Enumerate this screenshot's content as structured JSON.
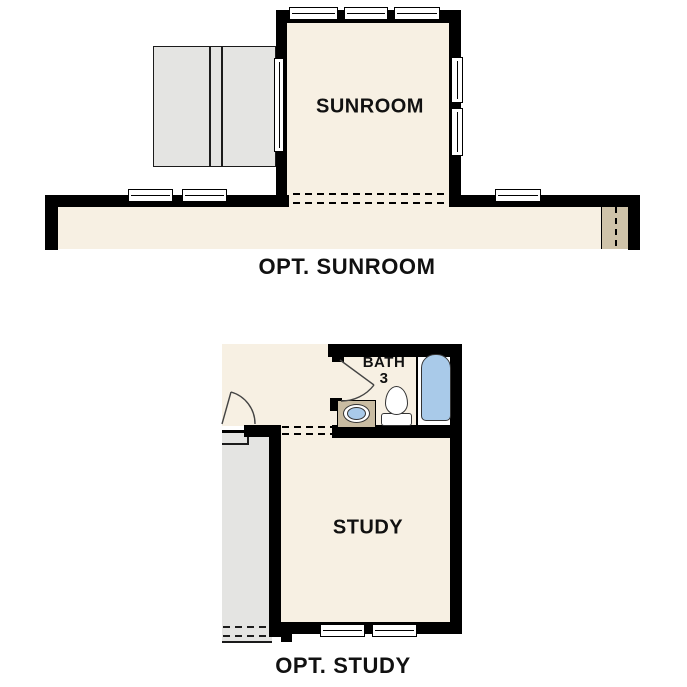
{
  "plans": {
    "sunroom": {
      "caption": "OPT. SUNROOM",
      "room_label": "SUNROOM"
    },
    "study": {
      "caption": "OPT. STUDY",
      "room_label": "STUDY",
      "bath": {
        "label": "BATH",
        "number": "3"
      }
    }
  },
  "colors": {
    "bg": "#ffffff",
    "wall": "#000000",
    "floor": "#f7f0e3",
    "deck": "#e4e4e2",
    "deck_outline": "#1b1b1b",
    "tan_strip": "#cfc3a9",
    "vanity": "#c9bca2",
    "fixture_blue": "#a9cae9",
    "fixture_outline": "#333333",
    "text": "#111111"
  }
}
